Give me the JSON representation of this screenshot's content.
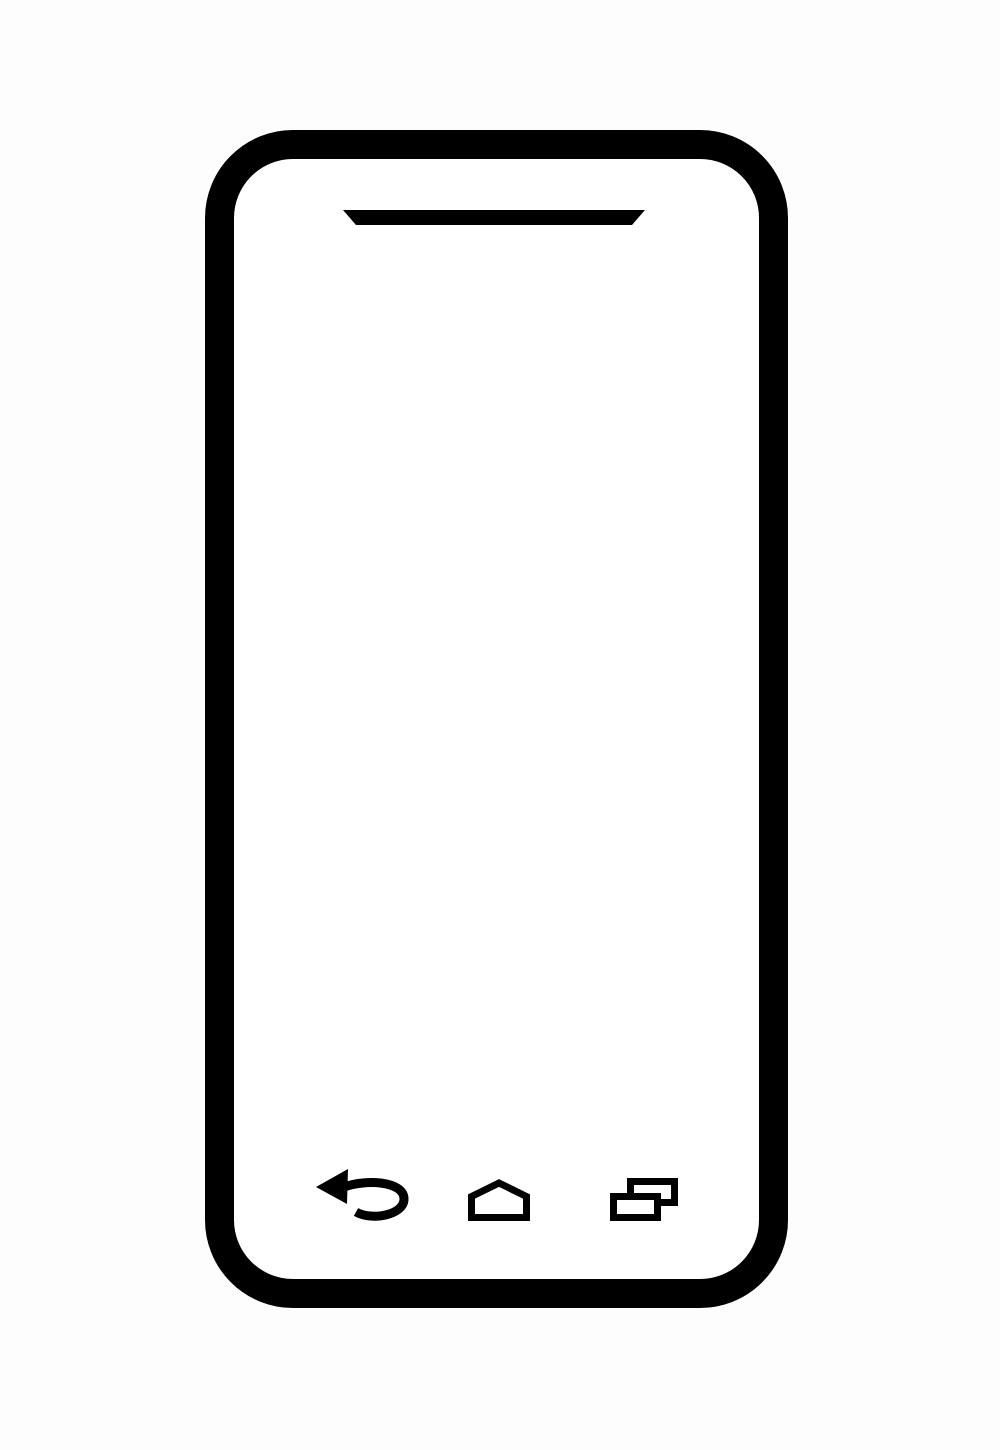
{
  "scene": {
    "description": "Black outline illustration of a smartphone on a plain light background",
    "background_color": "#fdfdfd",
    "line_color": "#000000",
    "screen_color": "#ffffff"
  },
  "phone": {
    "earpiece_speaker": {
      "shape": "trapezoid",
      "name": "earpiece-speaker"
    }
  },
  "navigation": {
    "items": [
      {
        "name": "back",
        "icon": "back-arrow-icon",
        "aria_label": "Back"
      },
      {
        "name": "home",
        "icon": "home-icon",
        "aria_label": "Home"
      },
      {
        "name": "recents",
        "icon": "recent-apps-icon",
        "aria_label": "Recent apps"
      }
    ]
  }
}
